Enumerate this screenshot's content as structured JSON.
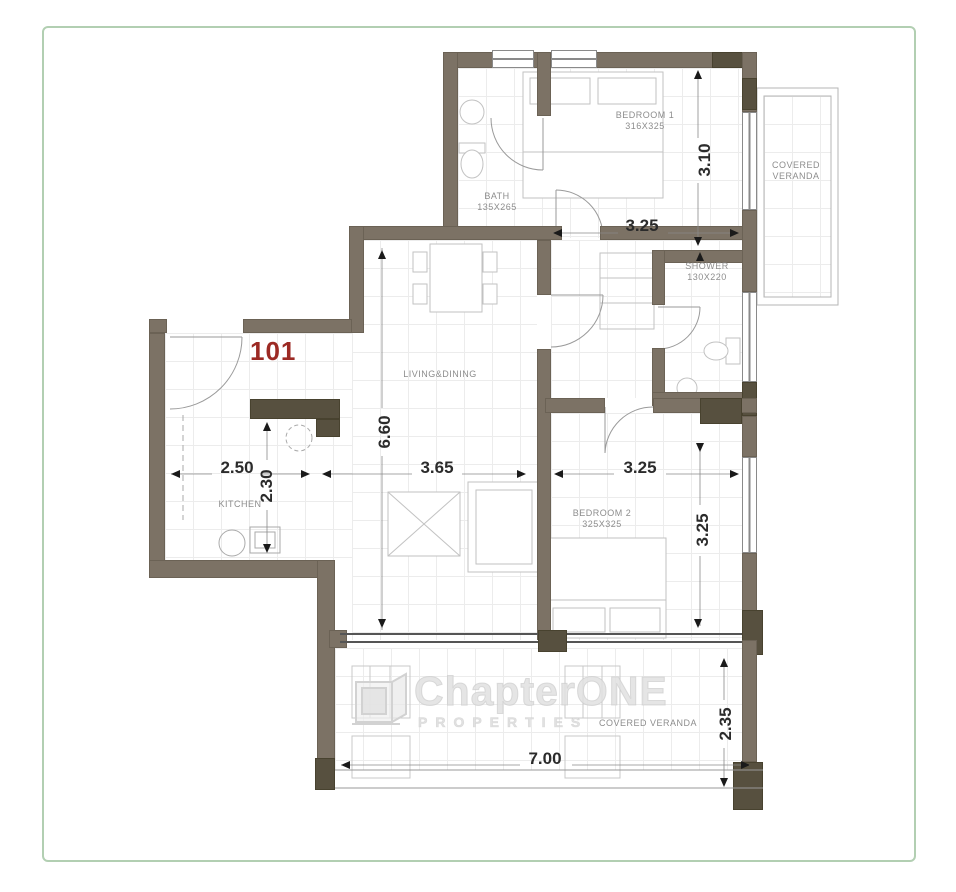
{
  "unit": {
    "number": "101",
    "number_color": "#9c2a24"
  },
  "rooms": {
    "bedroom1": {
      "name": "BEDROOM 1",
      "size": "316X325"
    },
    "bath": {
      "name": "BATH",
      "size": "135X265"
    },
    "shower": {
      "name": "SHOWER",
      "size": "130X220"
    },
    "living": {
      "name": "LIVING&DINING"
    },
    "kitchen": {
      "name": "KITCHEN"
    },
    "bedroom2": {
      "name": "BEDROOM 2",
      "size": "325X325"
    },
    "veranda_top": {
      "line1": "COVERED",
      "line2": "VERANDA"
    },
    "veranda_bottom": {
      "name": "COVERED VERANDA"
    }
  },
  "dims": {
    "bedroom1_width": "3.25",
    "bedroom1_depth": "3.10",
    "living_length": "6.60",
    "living_width": "3.65",
    "kitchen_width": "2.50",
    "kitchen_depth": "2.30",
    "bedroom2_width": "3.25",
    "bedroom2_depth": "3.25",
    "veranda_width": "7.00",
    "veranda_depth": "2.35"
  },
  "watermark": {
    "brand_prefix": "Chapter",
    "brand_suffix": "ONE",
    "tagline": "PROPERTIES"
  },
  "colors": {
    "wall": "#7c7265",
    "wall_dark": "#57503f",
    "border": "#b2cfb2"
  }
}
